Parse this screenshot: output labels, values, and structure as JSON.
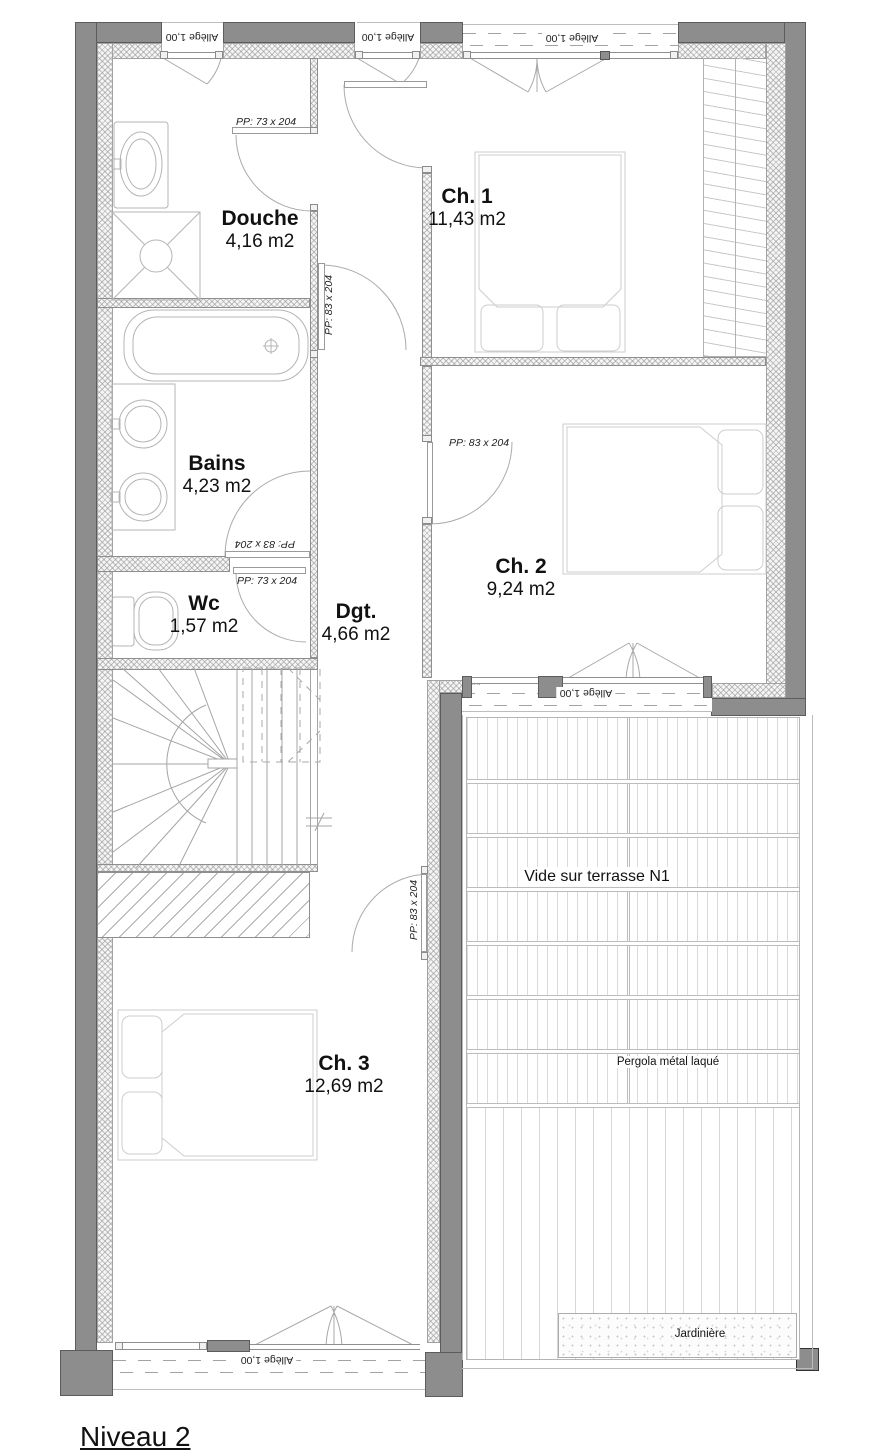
{
  "title": "Niveau 2",
  "rooms": {
    "douche": {
      "name": "Douche",
      "area": "4,16 m2"
    },
    "ch1": {
      "name": "Ch. 1",
      "area": "11,43 m2"
    },
    "bains": {
      "name": "Bains",
      "area": "4,23 m2"
    },
    "ch2": {
      "name": "Ch. 2",
      "area": "9,24 m2"
    },
    "wc": {
      "name": "Wc",
      "area": "1,57 m2"
    },
    "dgt": {
      "name": "Dgt.",
      "area": "4,66 m2"
    },
    "ch3": {
      "name": "Ch. 3",
      "area": "12,69 m2"
    }
  },
  "annotations": {
    "terrace_void": "Vide sur terrasse N1",
    "pergola": "Pergola métal laqué",
    "planter": "Jardinière"
  },
  "door_labels": {
    "pp73": "PP: 73 x 204",
    "pp83": "PP: 83 x 204"
  },
  "window_sill_label": "Allège 1,00",
  "colors": {
    "wall_gray": "#8d8d8d",
    "line_gray": "#a6a6a6",
    "text": "#111111"
  }
}
